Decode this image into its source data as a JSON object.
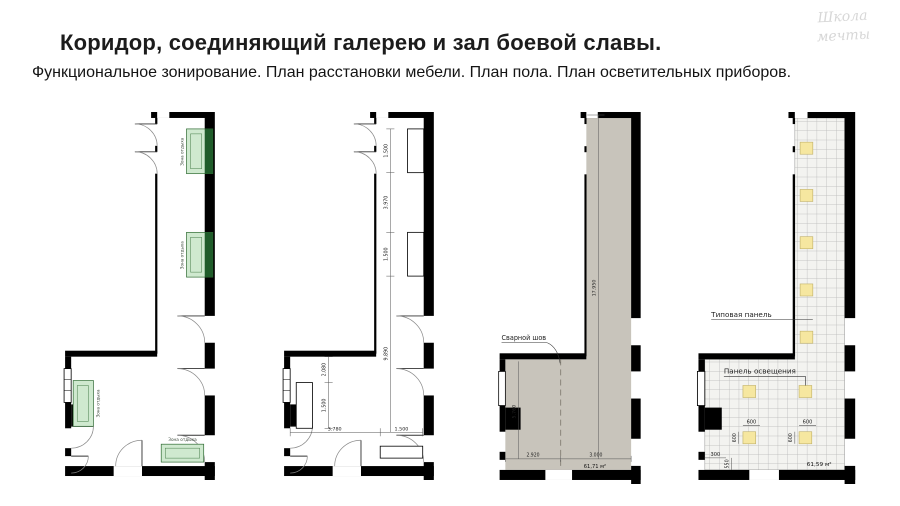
{
  "header": {
    "title": "Коридор, соединяющий галерею и зал боевой славы.",
    "subtitle": "Функциональное зонирование. План расстановки мебели. План пола. План осветительных приборов.",
    "logo": "Школа мечты"
  },
  "colors": {
    "bench_green": "#cfe9cf",
    "bench_green_dark": "#1f5c2a",
    "bench_border": "#2f6b33",
    "floor_gray": "#c8c4bb",
    "panel_yellow": "#f6e7a0",
    "panel_border": "#c2b26a",
    "wall_black": "#000000"
  },
  "plans": {
    "zoning": {
      "benches": [
        {
          "label": "Зона отдыха"
        },
        {
          "label": "Зона отдыха"
        },
        {
          "label": "Зона отдыха"
        },
        {
          "label": "Зона отдыха"
        }
      ]
    },
    "furniture": {
      "dims": {
        "bench1": "1.500",
        "gap": "3.970",
        "bench2": "1.500",
        "corridor": "9.890",
        "offset": "2.080",
        "bench3": "1.500",
        "span": "3.780",
        "bench4": "1.500"
      }
    },
    "floor": {
      "seam": "Сварной шов",
      "dims": {
        "length": "17.950",
        "height": "5.760",
        "left": "2.920",
        "right": "3.000"
      },
      "area": "61,71 м²"
    },
    "lighting": {
      "typical_panel": "Типовая панель",
      "light_panel": "Панель освещения",
      "dims": {
        "w1": "600",
        "w2": "600",
        "h1": "600",
        "h2": "600",
        "offset": "300",
        "edge": "550"
      },
      "area": "61,59 м²"
    }
  }
}
